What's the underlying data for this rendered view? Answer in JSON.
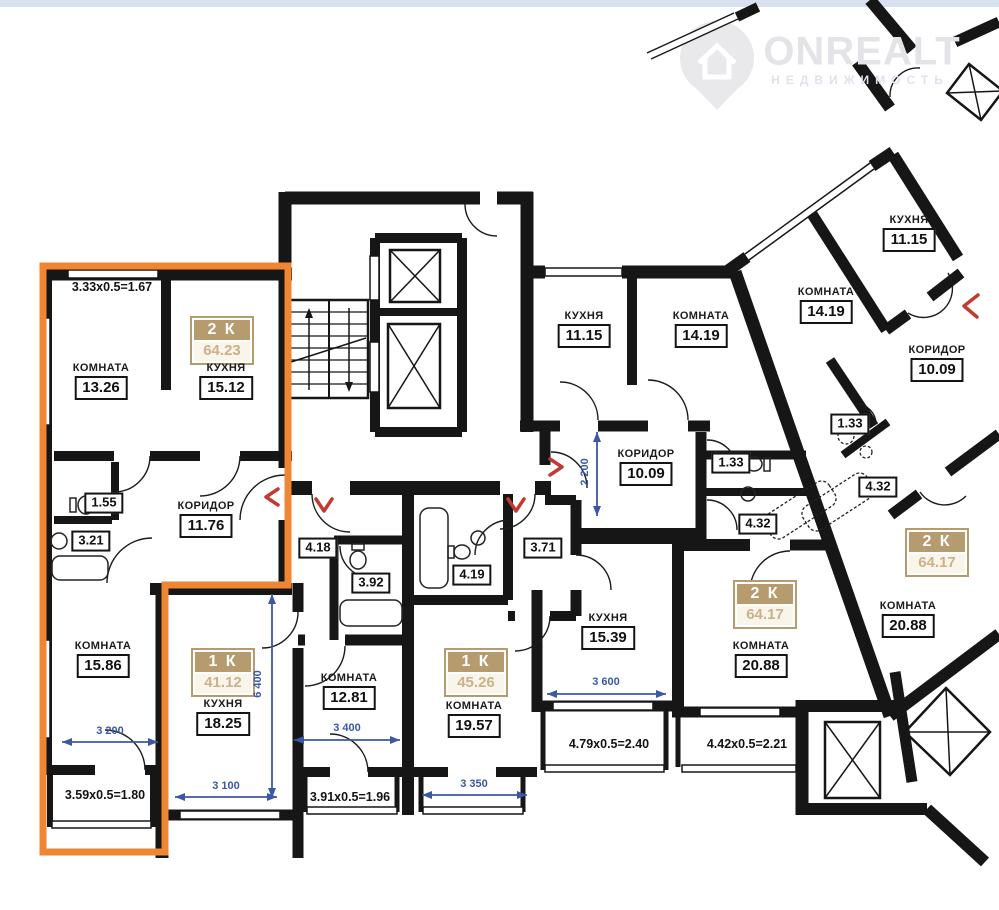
{
  "watermark": {
    "brand": "ONREALT",
    "subtitle": "НЕДВИЖИМОСТЬ"
  },
  "apartments": [
    {
      "type": "2 К",
      "area": "64.23"
    },
    {
      "type": "1 К",
      "area": "41.12"
    },
    {
      "type": "1 К",
      "area": "45.26"
    },
    {
      "type": "2 К",
      "area": "64.17"
    },
    {
      "type": "2 К",
      "area": "64.17"
    }
  ],
  "rooms": [
    {
      "name": "КОМНАТА",
      "area": "13.26"
    },
    {
      "name": "КУХНЯ",
      "area": "15.12"
    },
    {
      "name": "КОРИДОР",
      "area": "11.76"
    },
    {
      "name": "КОМНАТА",
      "area": "15.86"
    },
    {
      "name": "КУХНЯ",
      "area": "18.25"
    },
    {
      "name": "КОМНАТА",
      "area": "12.81"
    },
    {
      "name": "КОМНАТА",
      "area": "19.57"
    },
    {
      "name": "КУХНЯ",
      "area": "11.15"
    },
    {
      "name": "КОМНАТА",
      "area": "14.19"
    },
    {
      "name": "КОРИДОР",
      "area": "10.09"
    },
    {
      "name": "КУХНЯ",
      "area": "15.39"
    },
    {
      "name": "КОМНАТА",
      "area": "20.88"
    },
    {
      "name": "КОМНАТА",
      "area": "14.19"
    },
    {
      "name": "КУХНЯ",
      "area": "11.15"
    },
    {
      "name": "КОРИДОР",
      "area": "10.09"
    },
    {
      "name": "КОМНАТА",
      "area": "20.88"
    }
  ],
  "wet_areas": [
    "1.55",
    "3.21",
    "4.18",
    "3.92",
    "4.19",
    "3.71",
    "1.33",
    "4.32",
    "1.33",
    "4.32"
  ],
  "balcony_dims": [
    "3.33x0.5=1.67",
    "3.59x0.5=1.80",
    "3.91x0.5=1.96",
    "4.79x0.5=2.40",
    "4.42x0.5=2.21"
  ],
  "dimensions": [
    "3 200",
    "3 100",
    "3 400",
    "3 350",
    "3 600",
    "6 400",
    "2 200"
  ],
  "colors": {
    "highlight": "#ee8634",
    "dimension_blue": "#3b57a5",
    "entrance_red": "#c23b32",
    "badge_tan": "#b59b6d",
    "wall": "#161616",
    "top_strip": "#d8e1ef"
  }
}
